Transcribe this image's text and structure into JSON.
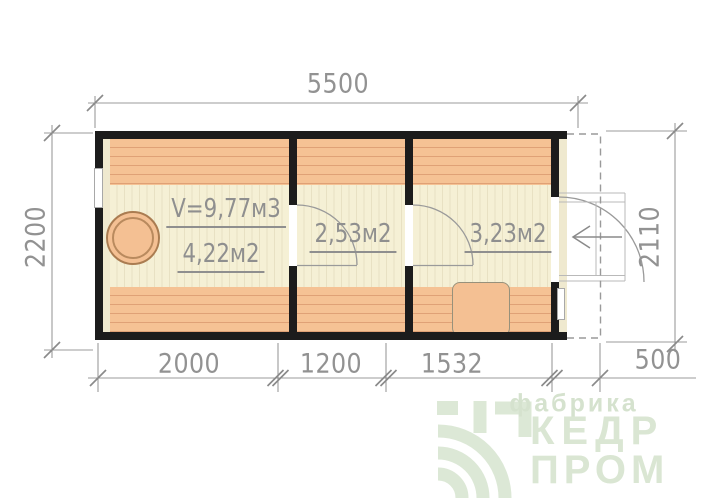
{
  "plan": {
    "dimensions": {
      "top_width": "5500",
      "left_height": "2200",
      "right_height": "2110",
      "bottom_segments": [
        "2000",
        "1200",
        "1532",
        "500"
      ]
    },
    "rooms": [
      {
        "name": "steam-room",
        "volume_label": "V=9,77м3",
        "area_label": "4,22м2"
      },
      {
        "name": "washing-room",
        "area_label": "2,53м2"
      },
      {
        "name": "entrance-room",
        "area_label": "3,23м2"
      }
    ],
    "colors": {
      "wall": "#1c1c1c",
      "plank": "#f5c294",
      "floor": "#f5f0d5",
      "drawing_line": "#999999",
      "dim_text": "#929292",
      "logo_green": "#dae6d3"
    }
  },
  "logo": {
    "tagline": "фабрика",
    "title_top": "КЕДР",
    "title_bottom": "ПРОМ"
  }
}
